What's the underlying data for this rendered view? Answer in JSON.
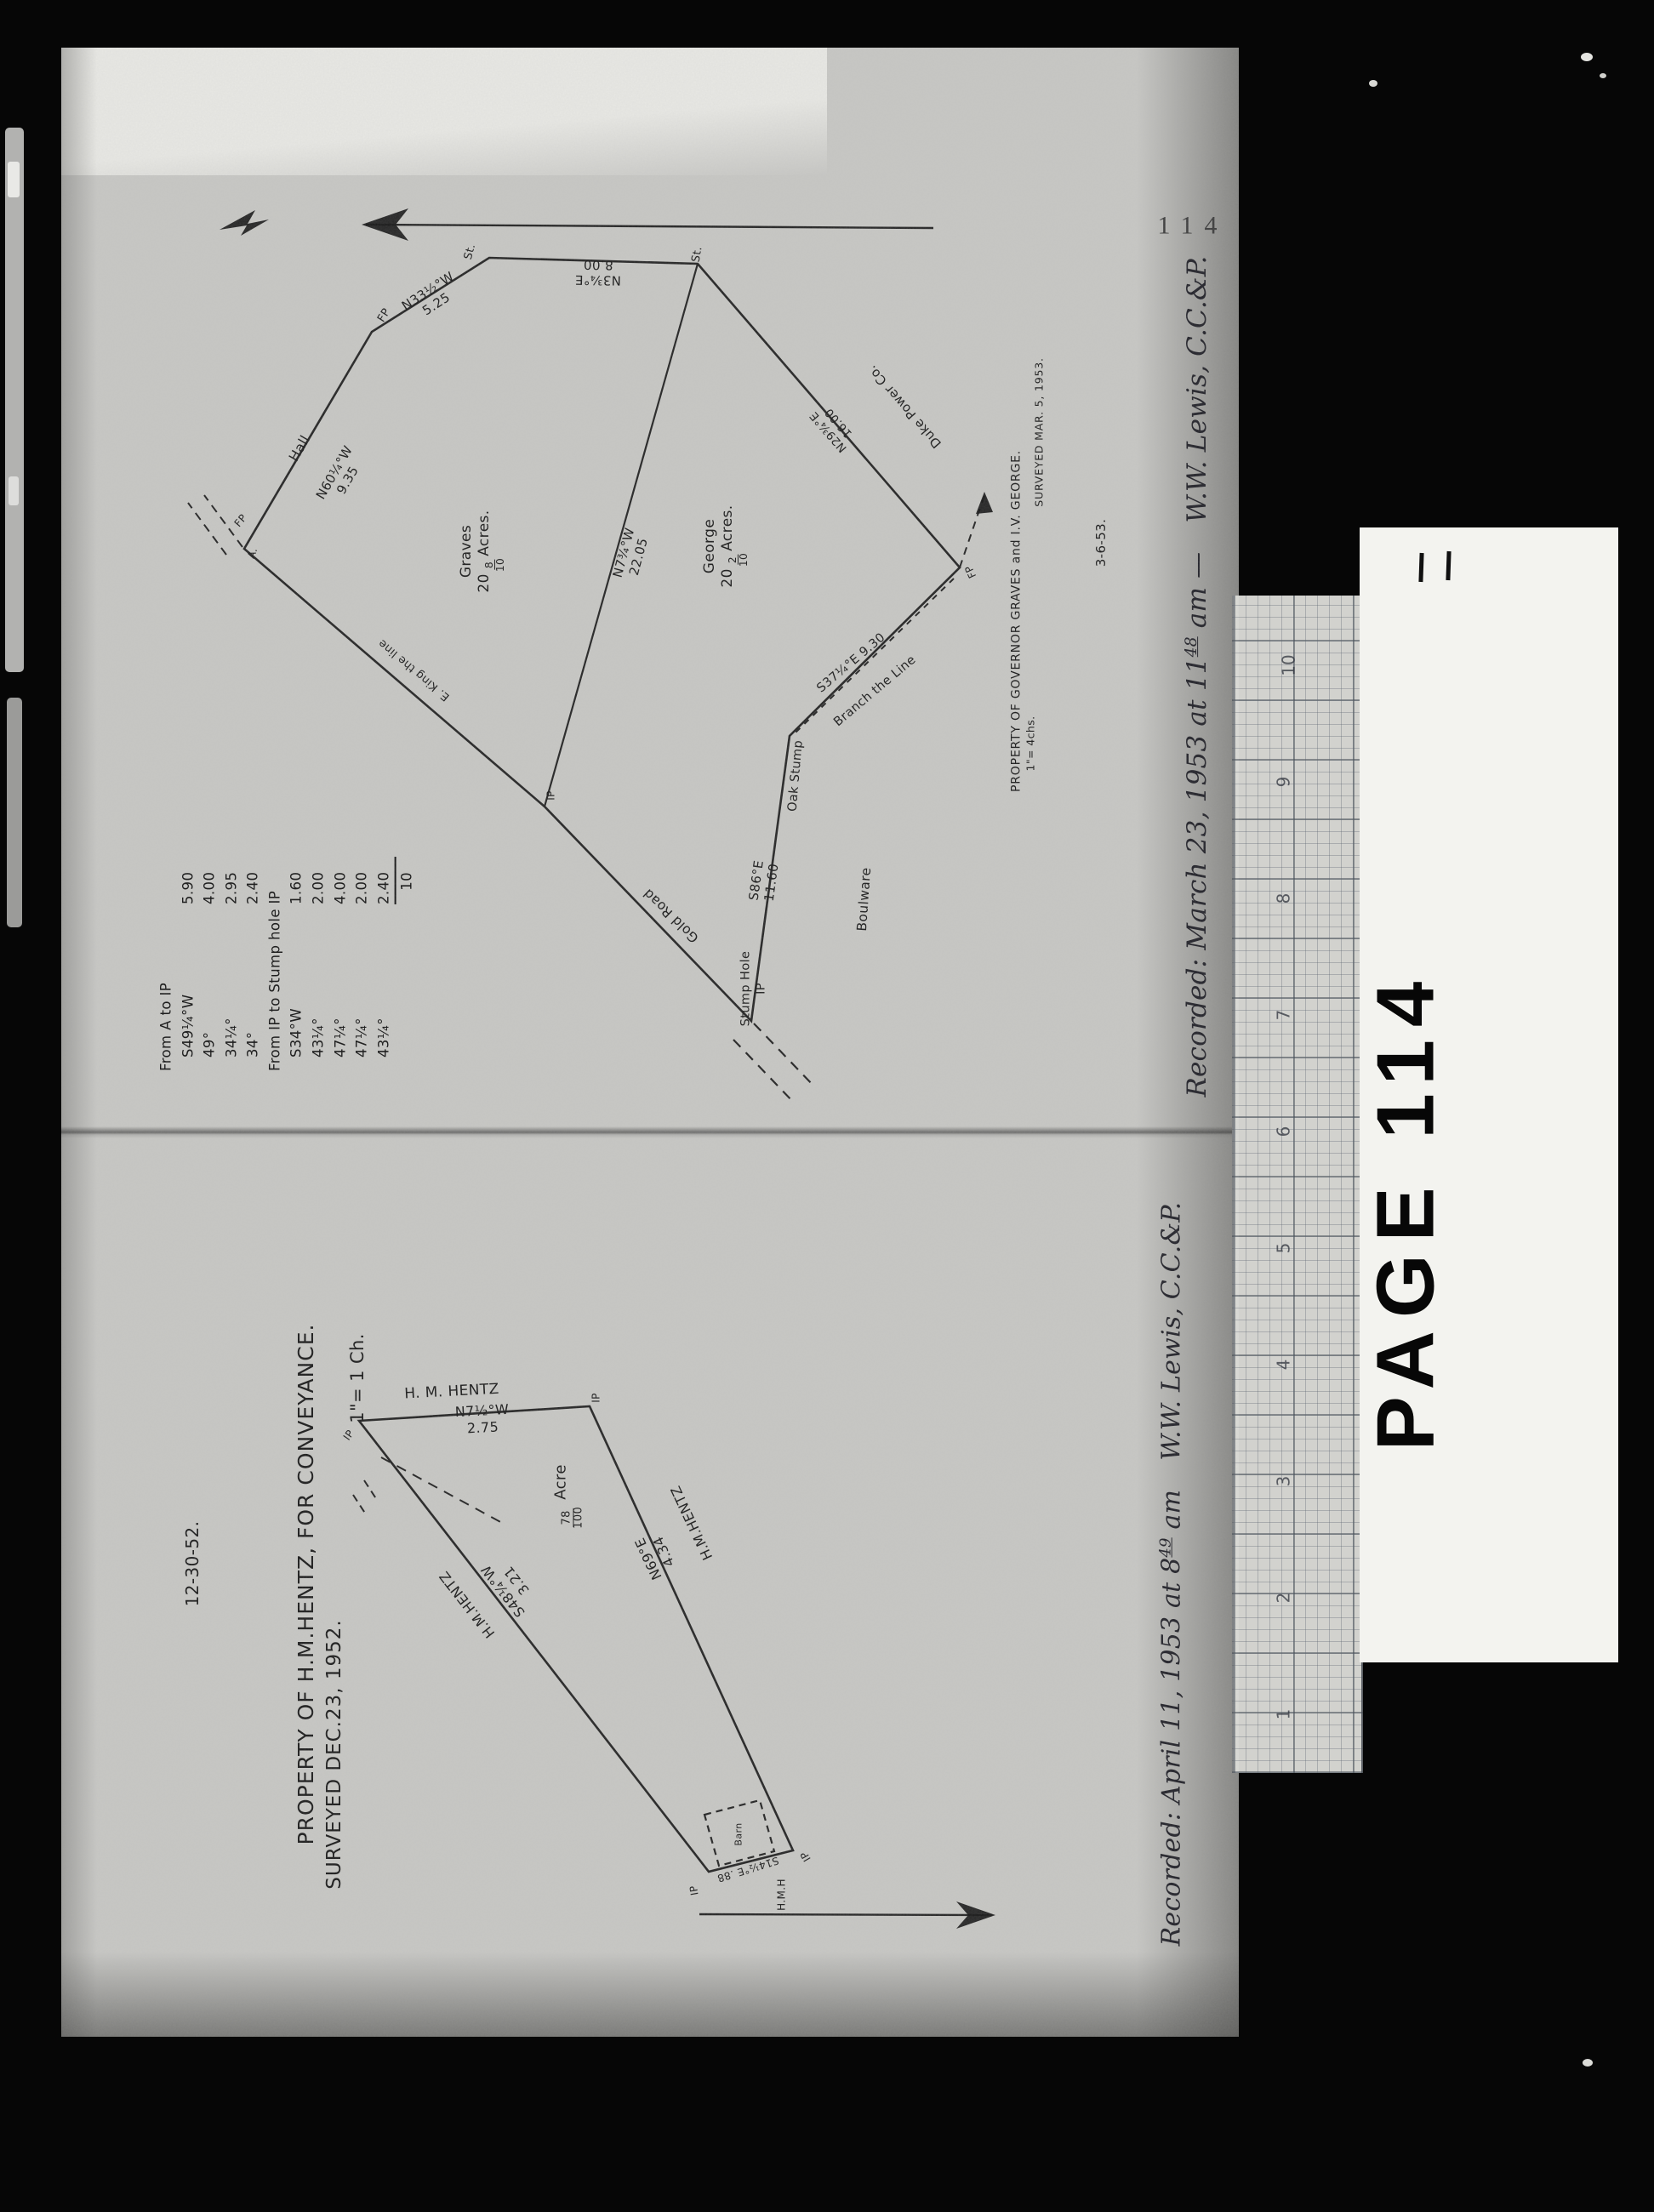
{
  "film": {
    "page_number": "114",
    "card_label": "PAGE 114"
  },
  "ruler": {
    "numbers": [
      "10",
      "9",
      "8",
      "7",
      "6",
      "5",
      "4",
      "3",
      "2",
      "1"
    ]
  },
  "top": {
    "recorded": {
      "pre": "Recorded: March 23, 1953 at 11",
      "sup": "48",
      "am": " am —",
      "signer": "W.W. Lewis, C.C.&P."
    },
    "title": "PROPERTY OF GOVERNOR GRAVES and I.V. GEORGE.",
    "surveyed": "SURVEYED MAR. 5, 1953.",
    "scale": "1\"= 4chs.",
    "filed": "3-6-53.",
    "parcels": {
      "graves": {
        "name": "Graves",
        "whole": "20",
        "num": "8",
        "den": "10",
        "unit": "Acres."
      },
      "george": {
        "name": "George",
        "whole": "20",
        "num": "2",
        "den": "10",
        "unit": "Acres."
      }
    },
    "adjoiners": {
      "hall": "Hall",
      "duke": "Duke Power Co.",
      "boulware": "Boulware",
      "king": "E. King the line"
    },
    "bearings": {
      "ab": {
        "b": "N60¼°W",
        "d": "9.35"
      },
      "bc": {
        "b": "N33½°W",
        "d": "5.25"
      },
      "cd": {
        "b": "N3¾°E",
        "d": "8.00"
      },
      "de": {
        "b": "N29¾°E",
        "d": "16.00"
      },
      "ef": "S37¼°E 9.30",
      "fg": {
        "b": "S86°E",
        "d": "11.60"
      },
      "divider": {
        "b": "N7¾°W",
        "d": "22.05"
      }
    },
    "features": {
      "branch": "Branch the Line",
      "oak": "Oak Stump",
      "road": "Gold Road",
      "stump1": "Stump Hole",
      "stump2": "IP"
    },
    "corners": {
      "a": "A.",
      "fp": "FP",
      "st": "St.",
      "ip": "IP"
    },
    "table": {
      "header1": "From A to IP",
      "rows1": [
        {
          "b": "S49¼°W",
          "d": "5.90"
        },
        {
          "b": "49°",
          "d": "4.00"
        },
        {
          "b": "34¼°",
          "d": "2.95"
        },
        {
          "b": "34°",
          "d": "2.40"
        }
      ],
      "header2": "From IP to Stump hole IP",
      "rows2": [
        {
          "b": "S34°W",
          "d": "1.60"
        },
        {
          "b": "43¼°",
          "d": "2.00"
        },
        {
          "b": "47¼°",
          "d": "4.00"
        },
        {
          "b": "47¼°",
          "d": "2.00"
        },
        {
          "b": "43¼°",
          "d": "2.40"
        }
      ],
      "total": "10"
    }
  },
  "bottom": {
    "recorded": {
      "pre": "Recorded: April 11, 1953 at 8",
      "sup": "49",
      "am": " am",
      "signer": "W.W. Lewis, C.C.&P."
    },
    "title": "PROPERTY OF H.M.HENTZ, FOR CONVEYANCE.",
    "scale": "1\"= 1 Ch.",
    "surveyed": "SURVEYED DEC.23, 1952.",
    "filed": "12-30-52.",
    "owner": "H.M.HENTZ",
    "owner_spaced": "H. M. HENTZ",
    "acreage": {
      "num": "78",
      "den": "100",
      "unit": "Acre"
    },
    "bearings": {
      "top": {
        "b": "N7½°W",
        "d": "2.75"
      },
      "right": {
        "b": "N69°E",
        "d": "4.34"
      },
      "left": {
        "b": "S48¼°W",
        "d": "3.21"
      },
      "bottom": "S14½°E .88"
    },
    "labels": {
      "hmh": "H.M.H",
      "building": "Barn",
      "ip": "IP"
    }
  }
}
